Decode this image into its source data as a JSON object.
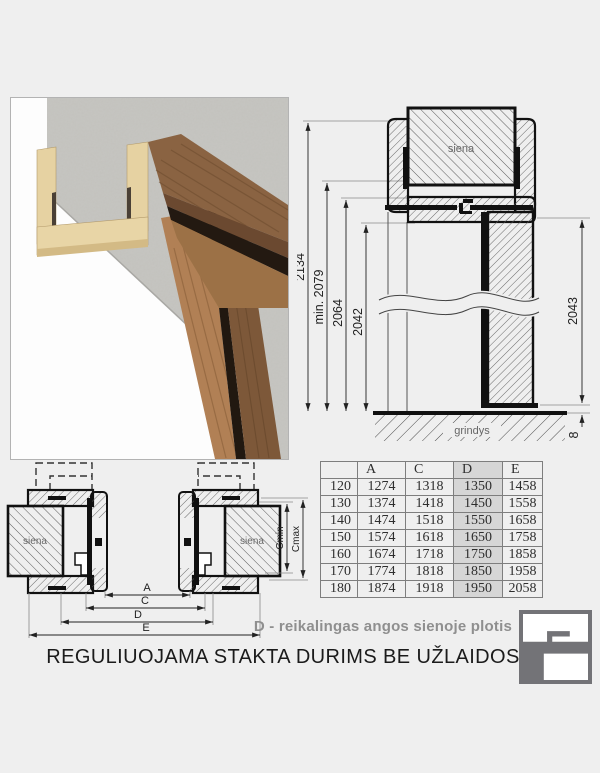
{
  "page": {
    "bg": "#efefef"
  },
  "photo": {
    "colors": {
      "concrete": "#c7c6c2",
      "mdf": "#e6d2a2",
      "walnut": "#8a6342",
      "walnut_dark": "#6b4930",
      "oak": "#b18055",
      "groove": "#231911"
    }
  },
  "elevation": {
    "dims_left": [
      "2134",
      "min. 2079",
      "2064",
      "2042"
    ],
    "dim_right": "2043",
    "floor_gap": "8",
    "wall_label": "siena",
    "floor_label": "grindys"
  },
  "section": {
    "wall_label_left": "siena",
    "wall_label_right": "siena",
    "dim_labels": [
      "A",
      "C",
      "D",
      "E"
    ],
    "dim_cmin": "Cmin",
    "dim_cmax": "Cmax"
  },
  "table": {
    "headers": [
      "",
      "A",
      "C",
      "D",
      "E"
    ],
    "rows": [
      [
        "120",
        "1274",
        "1318",
        "1350",
        "1458"
      ],
      [
        "130",
        "1374",
        "1418",
        "1450",
        "1558"
      ],
      [
        "140",
        "1474",
        "1518",
        "1550",
        "1658"
      ],
      [
        "150",
        "1574",
        "1618",
        "1650",
        "1758"
      ],
      [
        "160",
        "1674",
        "1718",
        "1750",
        "1858"
      ],
      [
        "170",
        "1774",
        "1818",
        "1850",
        "1958"
      ],
      [
        "180",
        "1874",
        "1918",
        "1950",
        "2058"
      ]
    ],
    "highlight_column": "D",
    "highlight_color": "#d6d6d6"
  },
  "note": "D - reikalingas angos sienoje plotis",
  "title": "REGULIUOJAMA STAKTA DURIMS BE UŽLAIDOS",
  "logo": {
    "color": "#737377"
  }
}
